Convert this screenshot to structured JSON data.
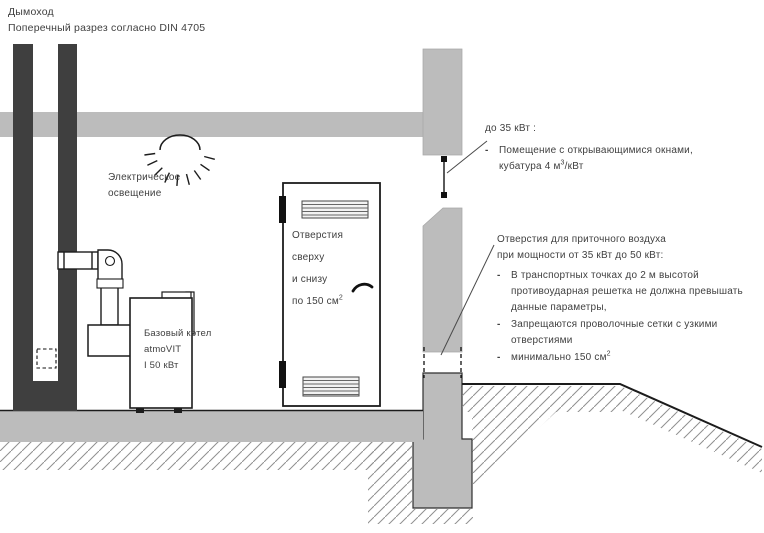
{
  "colors": {
    "wall_gray": "#bcbcbc",
    "dark_gray": "#3f3f3f",
    "line_black": "#1c1c1c",
    "hatch_gray": "#8f8f8f",
    "text_color": "#3f3f3f"
  },
  "header": {
    "line1": "Дымоход",
    "line2": "Поперечный разрез согласно  DIN 4705"
  },
  "lighting_label": {
    "line1": "Электрическое",
    "line2": "освещение"
  },
  "boiler_label": {
    "line1": "Базовый котел",
    "line2": "atmoVIT",
    "line3": "I  50 кВт"
  },
  "door_label": {
    "line1": "Отверстия",
    "line2": "сверху",
    "line3": "и снизу",
    "line4_text": "по 150 см",
    "line4_sup": "2"
  },
  "bullet_marker": "-",
  "note_up_to_35": {
    "title": "до 35 кВт :",
    "item1_line1": "Помещение с открывающимися окнами,",
    "item1_line2_text": "кубатура 4 м",
    "item1_line2_sup": "3",
    "item1_line2_tail": "/кВт"
  },
  "note_35_to_50": {
    "title_line1": "Отверстия для приточного воздуха",
    "title_line2": "при мощности от 35 кВт до 50 кВт:",
    "item1": "В  транспортных точках до 2 м высотой противоударная решетка не должна превышать данные параметры,",
    "item2": "Запрещаются проволочные сетки с узкими отверстиями",
    "item3_text": "минимально 150 см",
    "item3_sup": "2"
  }
}
